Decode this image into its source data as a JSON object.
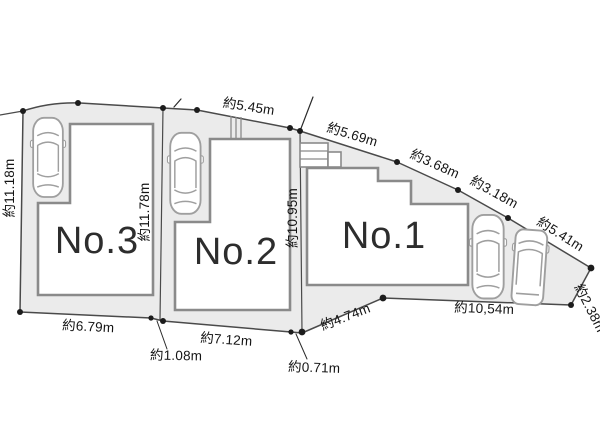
{
  "lots": {
    "no1": {
      "label": "No.1"
    },
    "no2": {
      "label": "No.2"
    },
    "no3": {
      "label": "No.3"
    }
  },
  "dimensions": {
    "west_side": "約11.18m",
    "divider_no3_no2": "約11.78m",
    "divider_no2_no1": "約10.95m",
    "north_no2_frontage": "約5.45m",
    "northeast_seg1": "約5.69m",
    "northeast_seg2": "約3.68m",
    "northeast_seg3": "約3.18m",
    "northeast_seg4": "約5.41m",
    "east_side": "約2.38m",
    "south_no1": "約10,54m",
    "south_no1_west": "約4.74m",
    "south_jog_no2_no1": "約0.71m",
    "south_no2": "約7.12m",
    "south_jog_no3_no2": "約1.08m",
    "south_no3": "約6.79m"
  },
  "icons": {
    "car": "car-top-view-icon",
    "van": "van-top-view-icon"
  },
  "colors": {
    "parcel_fill": "#ebebeb",
    "boundary": "#4a4a4a",
    "building_stroke": "#8a8a8a",
    "text": "#141414",
    "car_stroke": "#9f9f9f",
    "lot_label": "#2d2d2d",
    "bg": "#ffffff"
  }
}
